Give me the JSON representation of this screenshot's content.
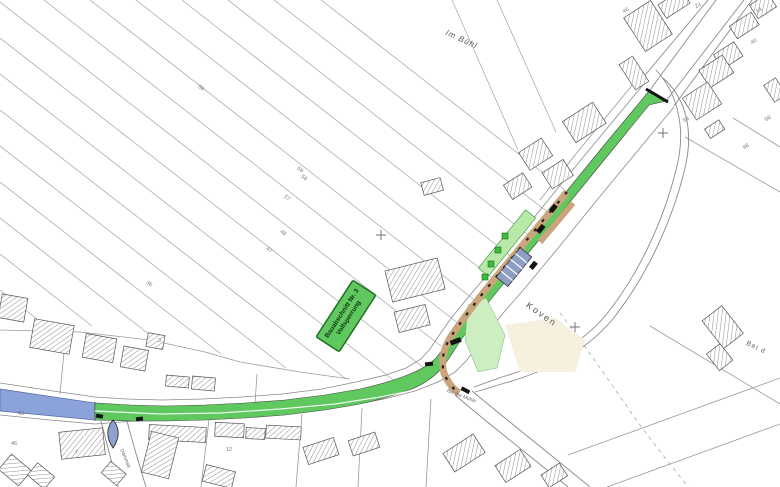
{
  "plan": {
    "type": "construction-site-plan",
    "labels": {
      "im_buehl": "Im Bühl",
      "koven": "Koven",
      "bei_d": "Bei d",
      "bei_der_muehle": "Bei der Mühle",
      "side_street": "Dammstr."
    },
    "banner": {
      "line1": "Bauabschnitt Nr. 3",
      "line2": "Vollsperrung"
    },
    "colors": {
      "construction_section_green": "#5fc85f",
      "adjacent_section_blue": "#8ca3da",
      "sidewalk_light_green": "#b9e9a9",
      "verge_tan": "#c9a57b",
      "parking_stalls_blue_gray": "#8d9fc4",
      "tree_green": "#3dbb3d",
      "landscaping_cream": "#f5f1de",
      "traffic_island_blue_gray": "#8da2cc"
    },
    "tiny_labels": [
      {
        "t": "59",
        "x": 299,
        "y": 166,
        "r": 35
      },
      {
        "t": "58",
        "x": 303,
        "y": 174,
        "r": 35
      },
      {
        "t": "57",
        "x": 286,
        "y": 194,
        "r": 35
      },
      {
        "t": "48",
        "x": 282,
        "y": 229,
        "r": 35
      },
      {
        "t": "47",
        "x": 268,
        "y": 246,
        "r": 35
      },
      {
        "t": "36",
        "x": 148,
        "y": 280,
        "r": 35
      },
      {
        "t": "68",
        "x": 200,
        "y": 84,
        "r": 35
      },
      {
        "t": "46",
        "x": 622,
        "y": 10,
        "r": -33
      },
      {
        "t": "23",
        "x": 694,
        "y": 5,
        "r": -33
      },
      {
        "t": "14",
        "x": 755,
        "y": 10,
        "r": -33
      },
      {
        "t": "40",
        "x": 750,
        "y": 41,
        "r": -33
      },
      {
        "t": "53",
        "x": 682,
        "y": 119,
        "r": -33
      },
      {
        "t": "98",
        "x": 742,
        "y": 146,
        "r": -33
      },
      {
        "t": "58",
        "x": 764,
        "y": 118,
        "r": -33
      },
      {
        "t": "7",
        "x": 75,
        "y": 450,
        "r": 0
      },
      {
        "t": "46",
        "x": 11,
        "y": 441,
        "r": 0
      },
      {
        "t": "12",
        "x": 226,
        "y": 447,
        "r": 0
      },
      {
        "t": "43",
        "x": 18,
        "y": 411,
        "r": 0
      },
      {
        "t": "3",
        "x": 158,
        "y": 338,
        "r": 0
      }
    ]
  }
}
